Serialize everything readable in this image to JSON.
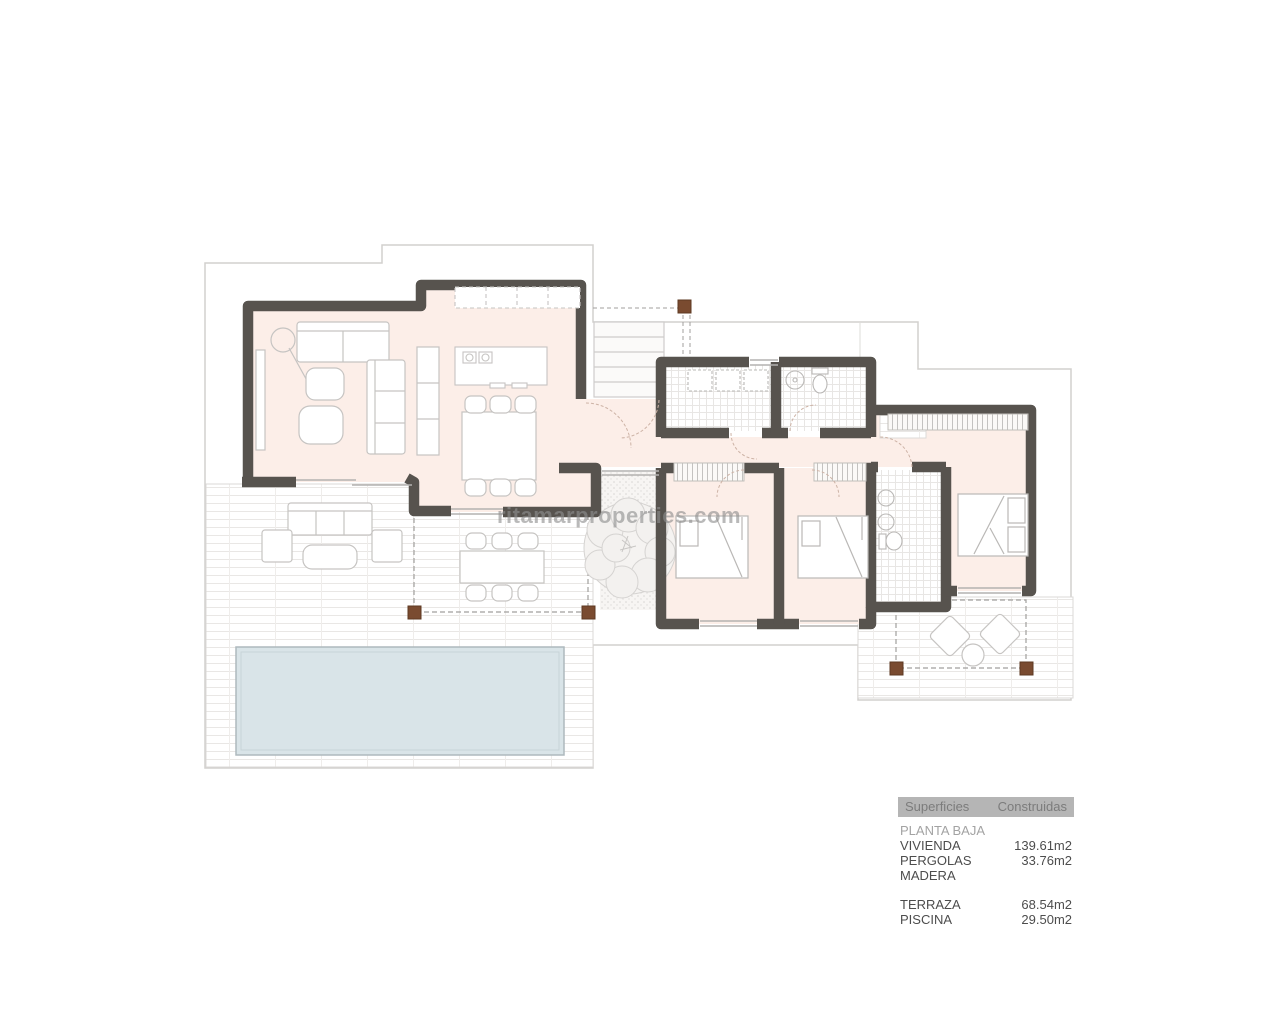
{
  "watermark": {
    "text": "ritamarproperties.com"
  },
  "legend": {
    "header": {
      "col1": "Superficies",
      "col2": "Construidas"
    },
    "section_title": "PLANTA BAJA",
    "groups": [
      {
        "rows": [
          {
            "label": "VIVIENDA",
            "value": "139.61m2"
          },
          {
            "label": "PERGOLAS MADERA",
            "value": "33.76m2"
          }
        ]
      },
      {
        "rows": [
          {
            "label": "TERRAZA",
            "value": "68.54m2"
          },
          {
            "label": "PISCINA",
            "value": "29.50m2"
          }
        ]
      }
    ]
  },
  "colors": {
    "wall": "#57534e",
    "floor_pink": "#fceee8",
    "pool_water": "#d9e4e8",
    "pergola_post": "#7a4b30",
    "boundary_line": "#d2d0ce",
    "furniture_line": "#c6c4c2",
    "legend_header_bg": "#b5b5b5"
  }
}
